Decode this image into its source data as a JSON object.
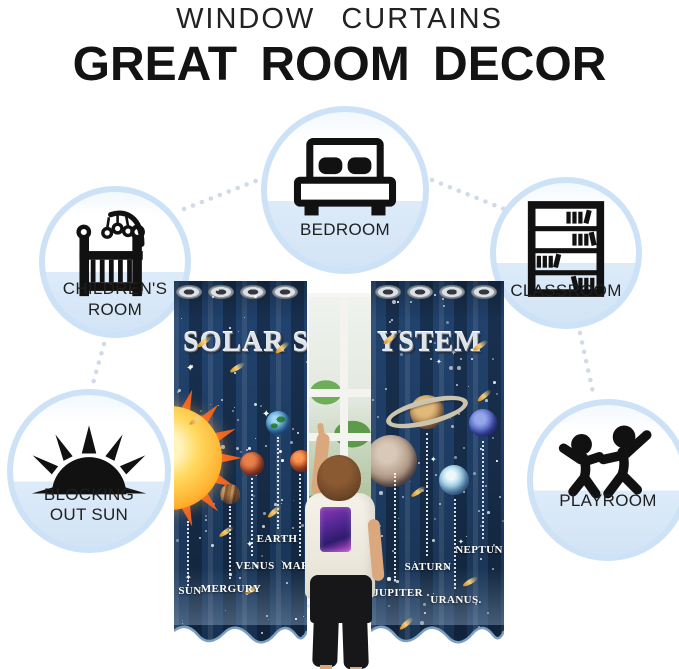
{
  "header": {
    "title": "WINDOW CURTAINS",
    "subtitle": "GREAT ROOM DECOR"
  },
  "badges": [
    {
      "id": "bedroom",
      "icon": "bed-icon",
      "label": "BEDROOM"
    },
    {
      "id": "childrens-room",
      "icon": "crib-icon",
      "label": "CHILDREN'S",
      "label2": "ROOM"
    },
    {
      "id": "classroom",
      "icon": "bookshelf-icon",
      "label": "CLASSROOM"
    },
    {
      "id": "blocking-out-sun",
      "icon": "sun-icon",
      "label": "BLOCKING",
      "label2": "OUT SUN"
    },
    {
      "id": "playroom",
      "icon": "playing-children-icon",
      "label": "PLAYROOM"
    }
  ],
  "curtain": {
    "print_title_left": "SOLAR S",
    "print_title_right": "YSTEM",
    "sparkle_glyph": "✦",
    "planet_labels": {
      "sun": "SUN",
      "mercury": "MERGURY",
      "venus": "VENUS",
      "earth": "EARTH",
      "mars": "MARS",
      "jupiter": "JUPITER",
      "saturn": "SATURN",
      "uranus": "URANUS.",
      "neptune": "NEPTUN"
    }
  },
  "colors": {
    "curtain_navy": "#1d3b61",
    "badge_fill_blue": "#d7e7f8",
    "badge_ring_blue": "#cde2f6",
    "comet_gold": "#e8b13f",
    "metallic_silver": "#dfe4ea",
    "icon_black": "#111111"
  }
}
